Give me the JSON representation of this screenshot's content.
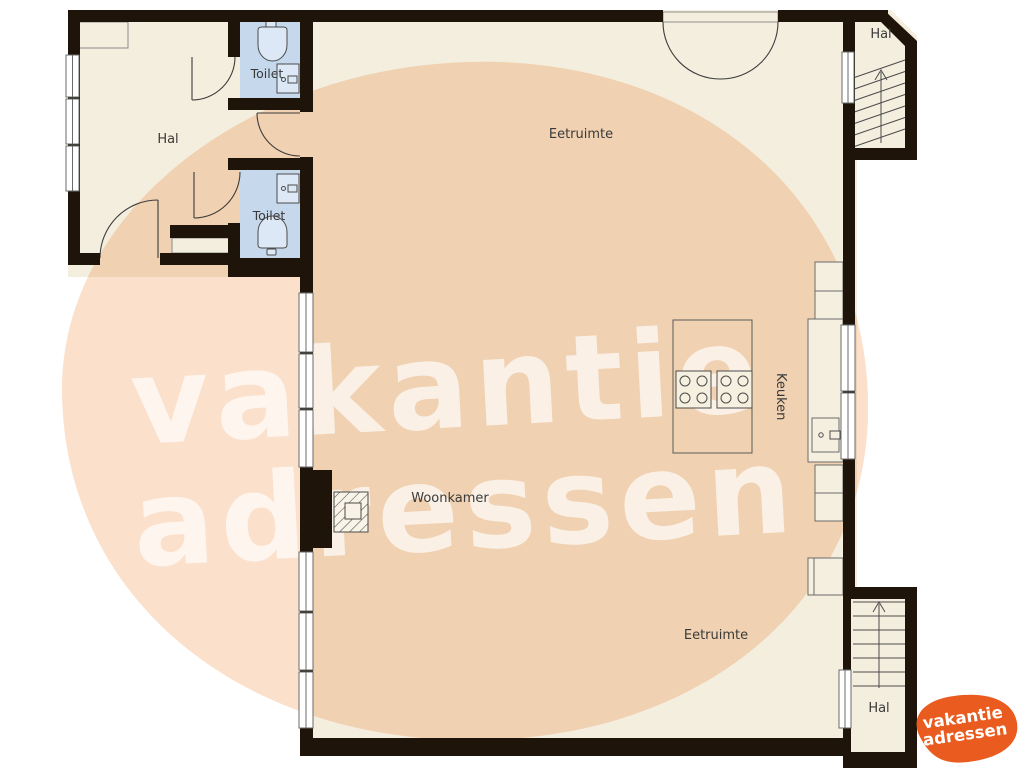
{
  "colors": {
    "wall": "#1e1409",
    "floor": "#f4eede",
    "toilet_blue": "#c6d8ec",
    "watermark_peach": "#fbe0cc",
    "logo_orange": "#e95b1e",
    "label_text": "#3a3a3a"
  },
  "labels": {
    "hal_left": "Hal",
    "toilet_top": "Toilet",
    "toilet_bottom": "Toilet",
    "eetruimte_top": "Eetruimte",
    "woonkamer": "Woonkamer",
    "eetruimte_bottom": "Eetruimte",
    "keuken": "Keuken",
    "hal_top_right": "Hal",
    "hal_bottom_right": "Hal"
  },
  "watermark": {
    "line1": "vakantie",
    "line2": "adressen"
  },
  "logo": {
    "line1": "vakantie",
    "line2": "adressen"
  }
}
